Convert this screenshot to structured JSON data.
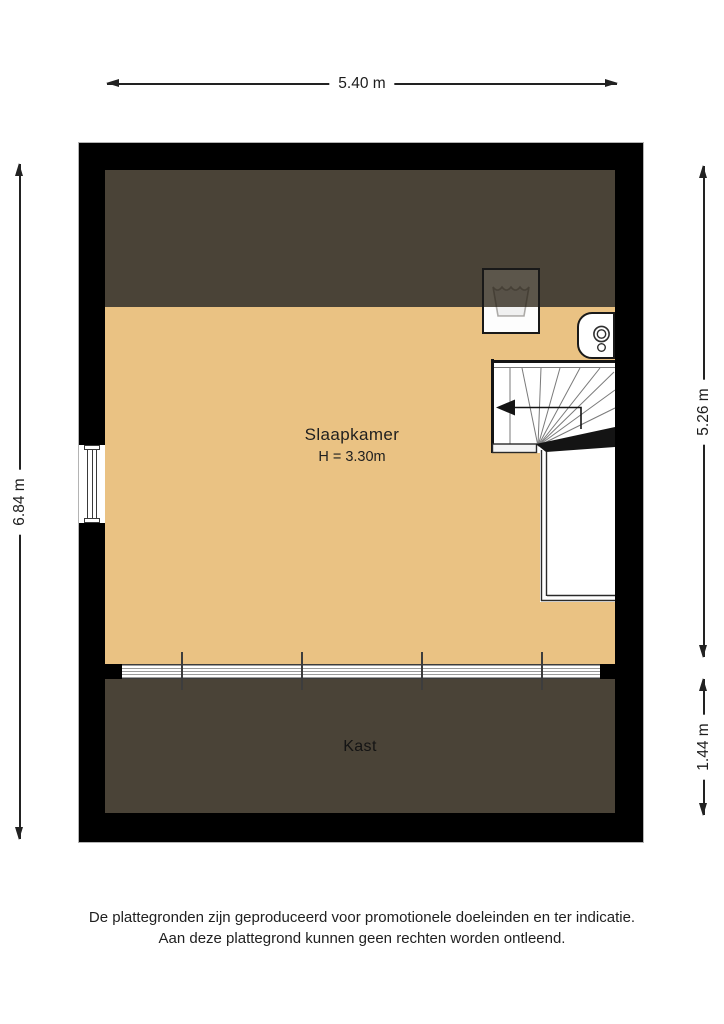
{
  "colors": {
    "floor": "#EAC283",
    "low_headroom": "#4A4337",
    "wall": "#000000",
    "background": "#FFFFFF",
    "line": "#1C1C1C"
  },
  "dimensions": {
    "top": "5.40 m",
    "left": "6.84 m",
    "right_upper": "5.26 m",
    "right_lower": "1.44 m"
  },
  "rooms": {
    "bedroom": {
      "name": "Slaapkamer",
      "height": "H = 3.30m"
    },
    "closet": {
      "name": "Kast"
    }
  },
  "icons": {
    "washing_machine": "washing-machine-icon",
    "boiler": "boiler-icon",
    "stair_arrow": "stair-direction-arrow-icon",
    "window": "window-icon"
  },
  "disclaimer": {
    "line1": "De plattegronden zijn geproduceerd voor promotionele doeleinden en ter indicatie.",
    "line2": "Aan deze plattegrond kunnen geen rechten worden ontleend."
  }
}
